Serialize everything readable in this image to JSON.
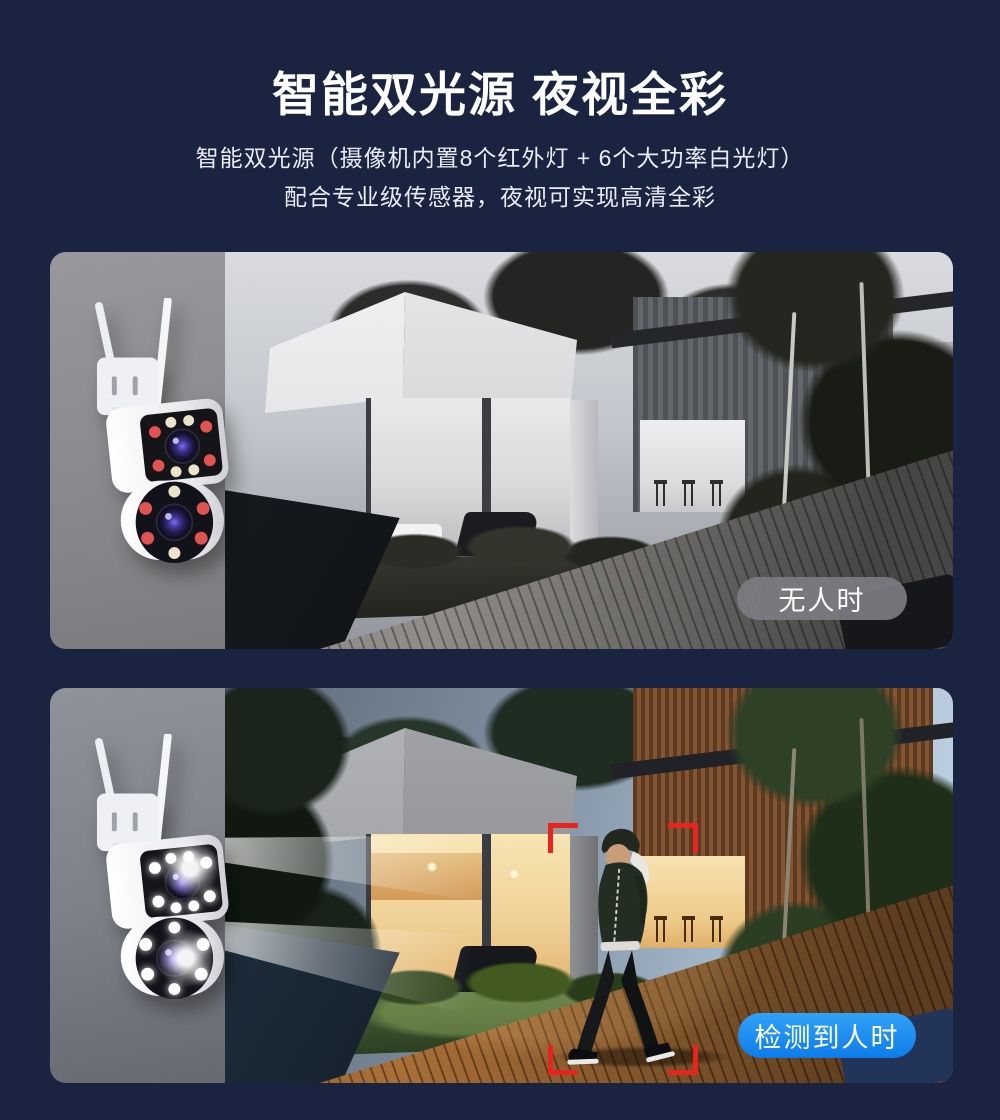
{
  "header": {
    "title": "智能双光源 夜视全彩",
    "subtitle_line1": "智能双光源（摄像机内置8个红外灯 + 6个大功率白光灯）",
    "subtitle_line2": "配合专业级传感器，夜视可实现高清全彩"
  },
  "panel_top": {
    "tag_label": "无人时"
  },
  "panel_bottom": {
    "tag_label": "检测到人时"
  },
  "colors": {
    "page_bg": "#1a2440",
    "tag_gray_bg": "#7c7c81",
    "tag_blue": "#1b8ef3",
    "bracket_red": "#e6251e",
    "title_text": "#ffffff"
  },
  "icons": {
    "camera": "dual-lens-security-camera",
    "detection_frame": "person-detection-brackets",
    "light_beams": "white-light-beams"
  }
}
